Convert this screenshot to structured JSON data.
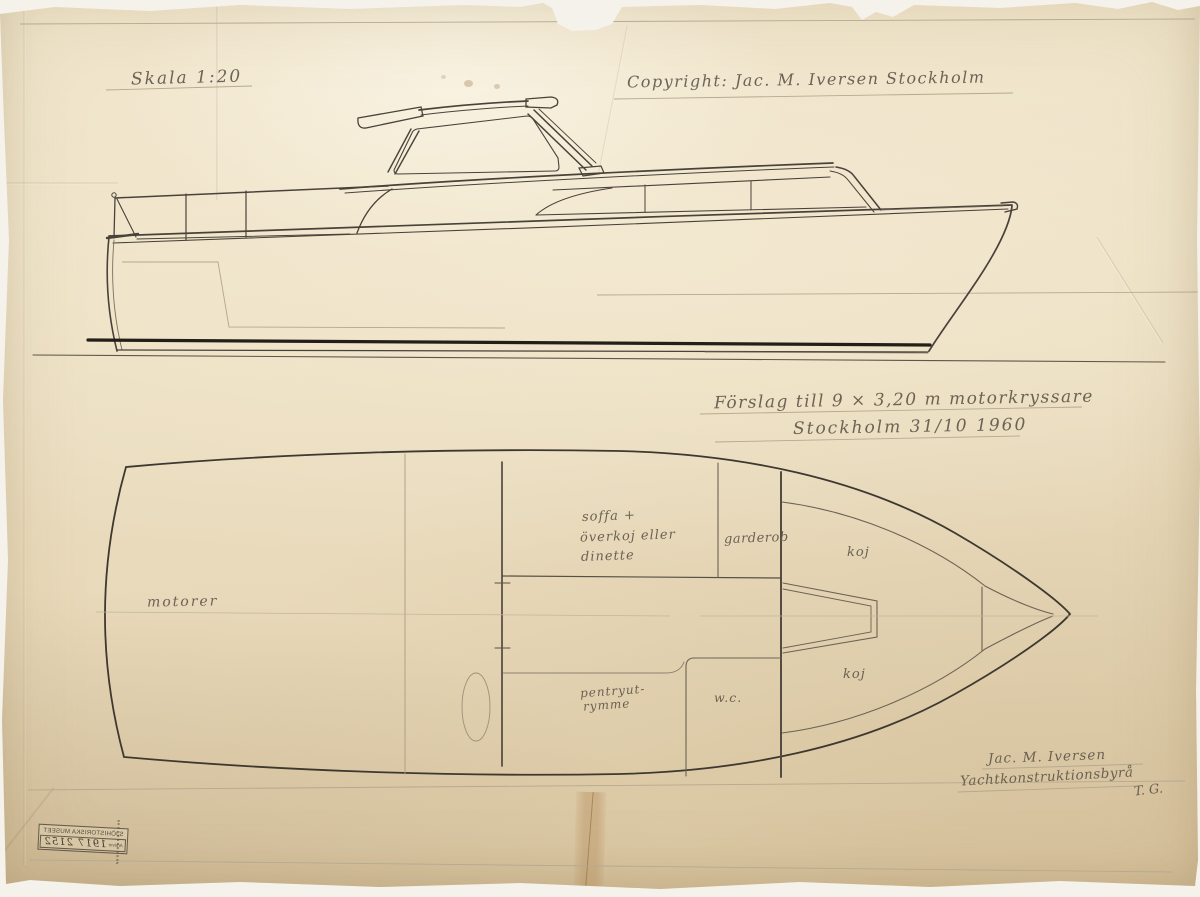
{
  "sheet": {
    "scale_label": "Skala 1:20",
    "copyright_label": "Copyright: Jac. M. Iversen  Stockholm",
    "title_line1": "Förslag till 9 × 3,20 m motorkryssare",
    "title_line2": "Stockholm 31/10 1960",
    "signature_name": "Jac. M. Iversen",
    "signature_firm": "Yachtkonstruktionsbyrå",
    "signature_initials": "T. G."
  },
  "plan_labels": {
    "engine_room": "motorer",
    "saloon_line1": "soffa +",
    "saloon_line2": "överkoj eller",
    "saloon_line3": "dinette",
    "wardrobe": "garderob",
    "berth_forward": "koj",
    "berth_aft": "koj",
    "pantry_line1": "pentryut-",
    "pantry_line2": "rymme",
    "toilet": "w.c."
  },
  "stamp": {
    "museum": "SJÖHISTORISKA MUSEET",
    "archive_label": "Arkivnr",
    "archive_number": "1917 2152"
  },
  "colors": {
    "paper": "#ecdfc2",
    "pencil_light": "#a89c85",
    "pencil": "#7a6f61",
    "ink": "#49423a",
    "waterline_ink": "#231e18"
  }
}
